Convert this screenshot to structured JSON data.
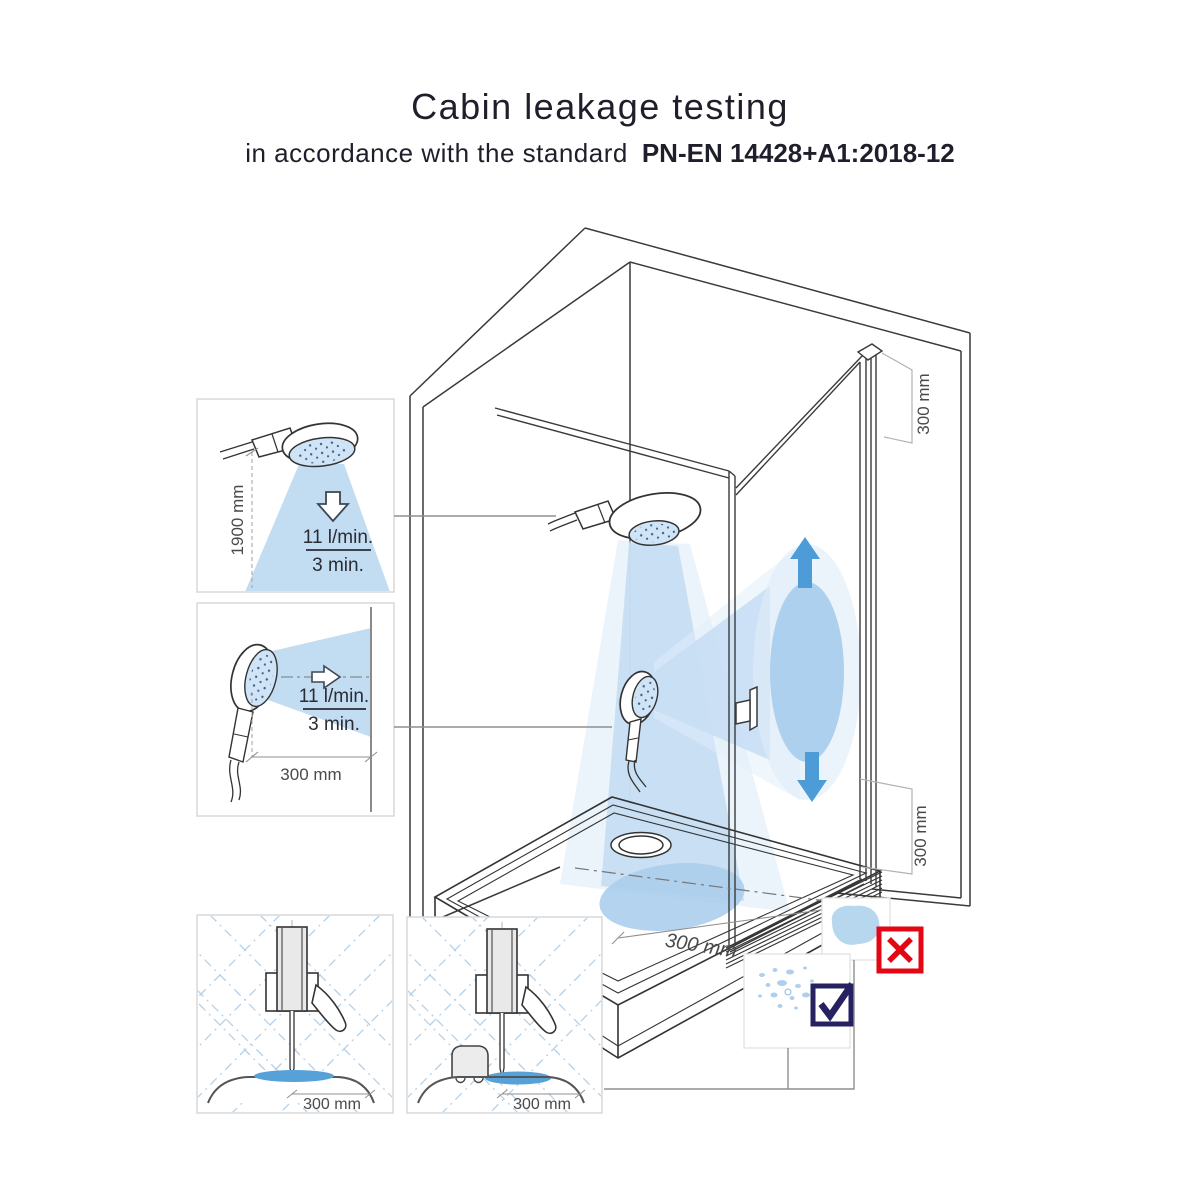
{
  "title": {
    "line1": "Cabin leakage testing",
    "line2_prefix": "in accordance with the standard",
    "standard_code": "PN-EN 14428+A1:2018-12"
  },
  "insets": {
    "overhead_spray": {
      "height_label": "1900 mm",
      "flow_rate": "11 l/min.",
      "duration": "3 min."
    },
    "horizontal_spray": {
      "distance_label": "300 mm",
      "flow_rate": "11 l/min.",
      "duration": "3 min."
    },
    "seal_detail_plain": {
      "distance_label": "300 mm"
    },
    "seal_detail_sponge": {
      "distance_label": "300 mm"
    }
  },
  "cabin": {
    "door_top_offset_label": "300 mm",
    "door_bottom_offset_label": "300 mm",
    "floor_target_label": "300 mm"
  },
  "icons": {
    "fail": "red-cross-box",
    "pass": "navy-check-box"
  },
  "colors": {
    "spray_fill": "#c6ddf3",
    "spray_halo": "#e0edf9",
    "impact_fill": "#a9cdec",
    "arrow_blue": "#4d9bd7",
    "puddle_blue": "#b7d7ef",
    "seal_water_blue": "#57a1d9",
    "fail_red": "#e30613",
    "pass_navy": "#262262",
    "line_dark": "#333333",
    "dimension_gray": "#4a4a4a"
  }
}
